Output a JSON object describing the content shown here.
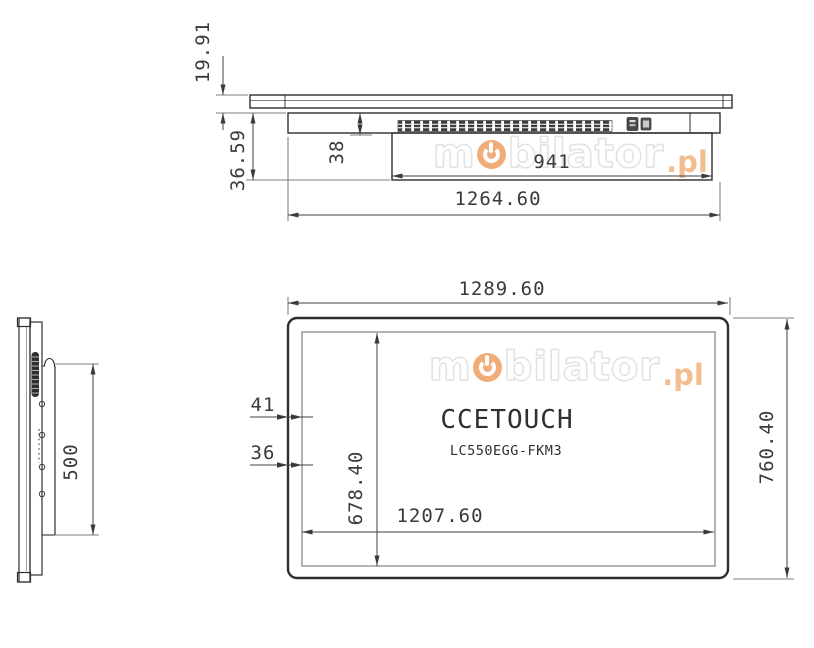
{
  "watermark": {
    "m": "m",
    "rest": "bilator",
    "tld": ".pl"
  },
  "top_view": {
    "dim_glass_height": "19.91",
    "dim_total_depth": "36.59",
    "dim_body_depth": "38",
    "dim_rear_width": "941",
    "dim_overall_width": "1264.60"
  },
  "side_view": {
    "dim_mount_height": "500"
  },
  "front_view": {
    "brand": "CCETOUCH",
    "model": "LC550EGG-FKM3",
    "dim_overall_width": "1289.60",
    "dim_overall_height": "760.40",
    "dim_screen_width": "1207.60",
    "dim_screen_height": "678.40",
    "dim_bezel_a": "41",
    "dim_bezel_b": "36"
  },
  "colors": {
    "line": "#2e2e2e",
    "dim_text": "#3a3a3a",
    "inner_frame": "#9a9a9a",
    "watermark_orange": "#f0ad7a",
    "watermark_outline": "#e2e2e2"
  }
}
